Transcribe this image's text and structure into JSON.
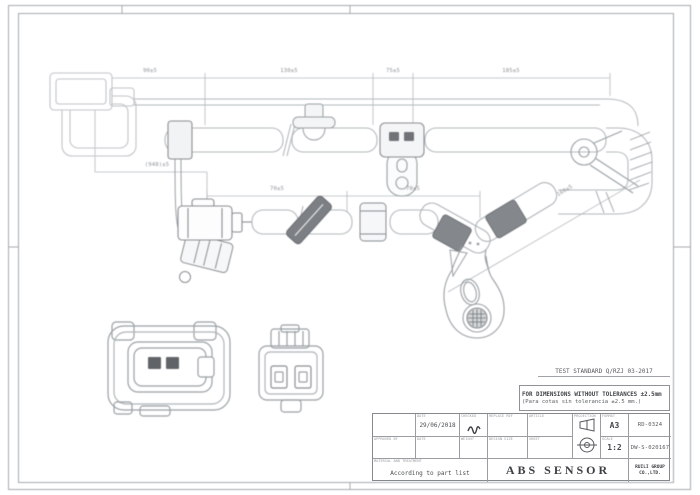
{
  "drawing": {
    "dimension_labels": {
      "top": [
        "90±5",
        "130±5",
        "75±5",
        "185±5"
      ],
      "lower": [
        "70±5",
        "70±5"
      ],
      "branch": "(948)±5",
      "diagonal": "160±5"
    },
    "colors": {
      "line_light": "#b4b9bd",
      "line_medium": "#9aa0a4",
      "fill_dark": "#84888c",
      "text_dark": "#4a4e52"
    }
  },
  "notes": {
    "test_standard": "TEST STANDARD Q/RZJ 03-2017",
    "tolerance_en": "FOR DIMENSIONS WITHOUT TOLERANCES ±2.5mm",
    "tolerance_es": "(Para cotas sin tolerancia ±2.5 mm.)"
  },
  "title_block": {
    "projection_label": "PROJECTION",
    "row1": {
      "date_label": "DATE",
      "date_value": "29/06/2018",
      "checked_label": "CHECKED",
      "replace_label": "REPLACE REF",
      "article_label": "ARTICLE",
      "format_label": "FORMAT",
      "format_value": "A3",
      "code": "RD-0324"
    },
    "row2": {
      "approved_label": "APPROVED BY",
      "date_label": "DATE",
      "weight_label": "WEIGHT",
      "design_label": "DESIGN SIZE",
      "sheet_label": "SHEET",
      "scale_label": "SCALE",
      "scale_value": "1:2",
      "code": "DW-S-020167"
    },
    "row3": {
      "material_label": "MATERIAL AND TREATMENT",
      "material_value": "According to part list",
      "title": "ABS SENSOR",
      "company": "RUILI GROUP CO.,LTD."
    }
  }
}
